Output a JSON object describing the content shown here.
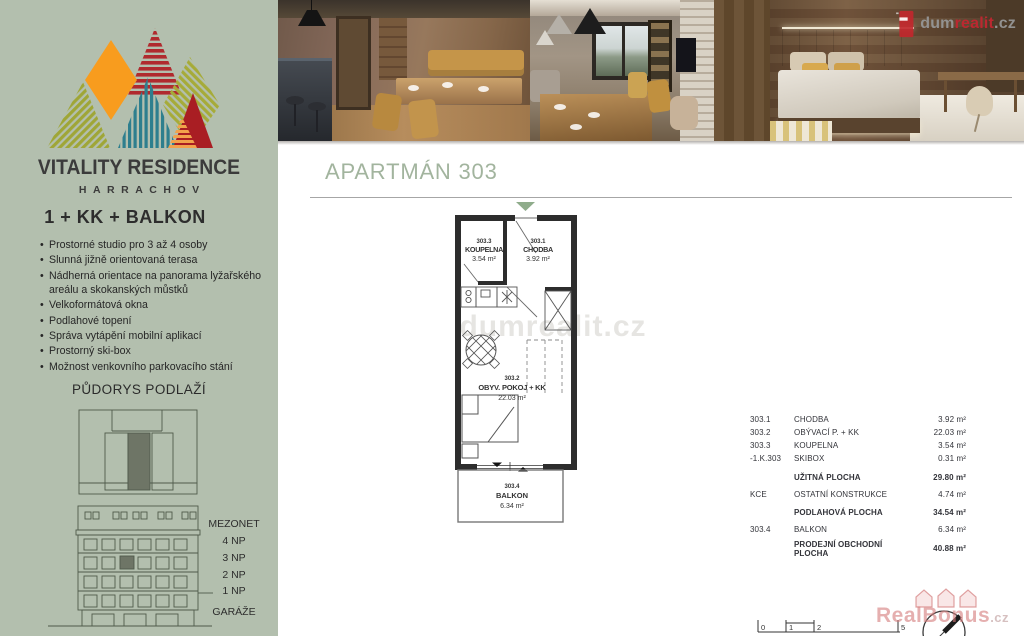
{
  "brand": {
    "name": "VITALITY RESIDENCE",
    "location": "HARRACHOV"
  },
  "sidebar": {
    "unit_type": "1 + KK + BALKON",
    "features": [
      "Prostorné studio pro 3 až 4 osoby",
      "Slunná jižně orientovaná terasa",
      "Nádherná orientace na panorama lyžařského areálu a skokanských můstků",
      "Velkoformátová okna",
      "Podlahové topení",
      "Správa vytápění mobilní aplikací",
      "Prostorný ski-box",
      "Možnost venkovního parkovacího stání"
    ],
    "floorplan_heading": "PŮDORYS PODLAŽÍ",
    "floor_labels": [
      "MEZONET",
      "4 NP",
      "3 NP",
      "2 NP",
      "1 NP",
      "GARÁŽE"
    ]
  },
  "agency_logo": {
    "prefix": "dum",
    "accent": "realit",
    "suffix": ".cz"
  },
  "main": {
    "title": "APARTMÁN 303",
    "plan_watermark": "dumrealit.cz",
    "corner_watermark": "RealBonus",
    "corner_watermark_suffix": ".cz"
  },
  "floor_plan": {
    "rooms": {
      "koupelna": {
        "code": "303.3",
        "name": "KOUPELNA",
        "area": "3.54 m²"
      },
      "chodba": {
        "code": "303.1",
        "name": "CHODBA",
        "area": "3.92 m²"
      },
      "obyvaci_pokoj": {
        "code": "303.2",
        "name": "OBYV. POKOJ + KK",
        "area": "22.03 m²"
      },
      "balkon": {
        "code": "303.4",
        "name": "BALKON",
        "area": "6.34 m²"
      }
    }
  },
  "area_table": {
    "rows": [
      {
        "code": "303.1",
        "name": "CHODBA",
        "value": "3.92 m²"
      },
      {
        "code": "303.2",
        "name": "OBÝVACÍ P. + KK",
        "value": "22.03 m²"
      },
      {
        "code": "303.3",
        "name": "KOUPELNA",
        "value": "3.54 m²"
      },
      {
        "code": "-1.K.303",
        "name": "SKIBOX",
        "value": "0.31 m²"
      },
      {
        "code": "",
        "name": "UŽITNÁ PLOCHA",
        "value": "29.80 m²"
      },
      {
        "code": "KCE",
        "name": "OSTATNÍ KONSTRUKCE",
        "value": "4.74 m²"
      },
      {
        "code": "",
        "name": "PODLAHOVÁ PLOCHA",
        "value": "34.54 m²"
      },
      {
        "code": "303.4",
        "name": "BALKON",
        "value": "6.34 m²"
      },
      {
        "code": "",
        "name": "PRODEJNÍ  OBCHODNÍ PLOCHA",
        "value": "40.88 m²"
      }
    ]
  },
  "scale_bar": {
    "labels": [
      "0",
      "1",
      "2",
      "5"
    ]
  },
  "colors": {
    "sidebar_bg": "#b3bfae",
    "title_green": "#a2b49e",
    "entry_marker_green": "#8fac8b",
    "plan_wall": "#2d2d2d",
    "diagram_highlight": "#6e7566",
    "logo_orange": "#f89c1e",
    "logo_red": "#a91e23",
    "logo_teal": "#2e7f8e",
    "logo_olive": "#9fa637",
    "agency_red": "#bb2830",
    "watermark_pink": "#d37a7a"
  }
}
